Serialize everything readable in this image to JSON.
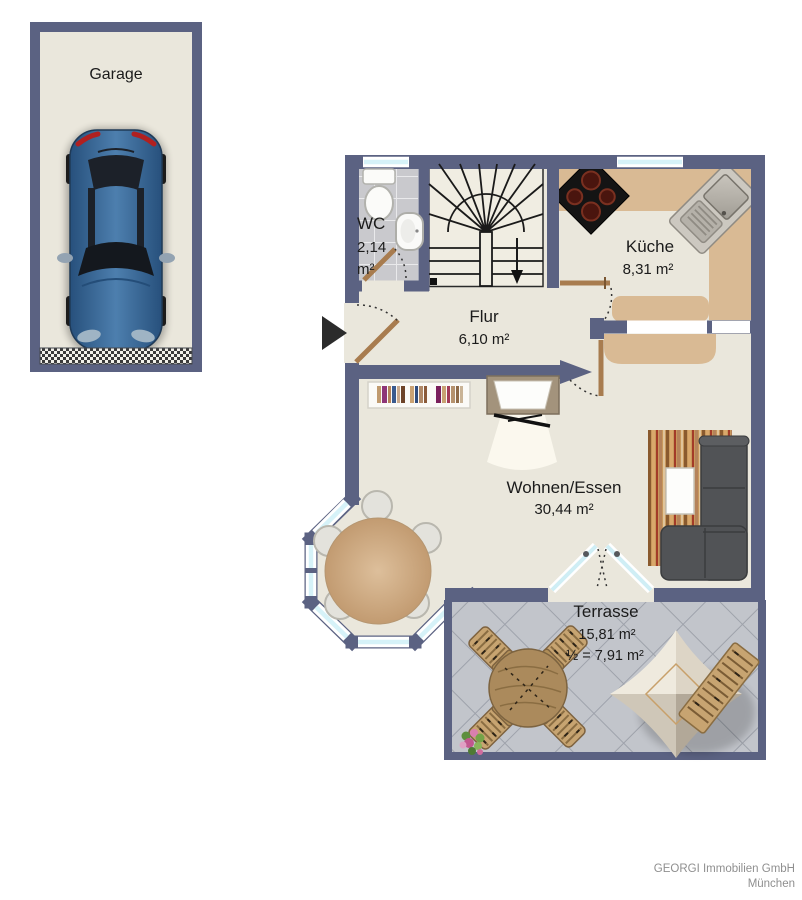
{
  "plan_title": "Erdgeschoss Grundriss",
  "rooms": {
    "garage": {
      "label": "Garage"
    },
    "wc": {
      "label": "WC",
      "area1": "2,14",
      "area2": "m²"
    },
    "kueche": {
      "label": "Küche",
      "area": "8,31 m²"
    },
    "flur": {
      "label": "Flur",
      "area": "6,10 m²"
    },
    "wohnen": {
      "label": "Wohnen/Essen",
      "area": "30,44 m²"
    },
    "terrasse": {
      "label": "Terrasse",
      "area": "15,81 m²",
      "area_half": "½ = 7,91 m²"
    }
  },
  "footer": {
    "line1": "GEORGI Immobilien GmbH",
    "line2": "München"
  },
  "colors": {
    "wall": "#5b6282",
    "floor": "#eae7dc",
    "counter": "#d9ba94",
    "window_glass": "#d6f2f8",
    "terrace_tile": "#c2c5cb",
    "door_wood": "#a87c4f",
    "car_body": "#3b6b9e",
    "sofa": "#515356",
    "credit_text": "#8f8f8f"
  }
}
